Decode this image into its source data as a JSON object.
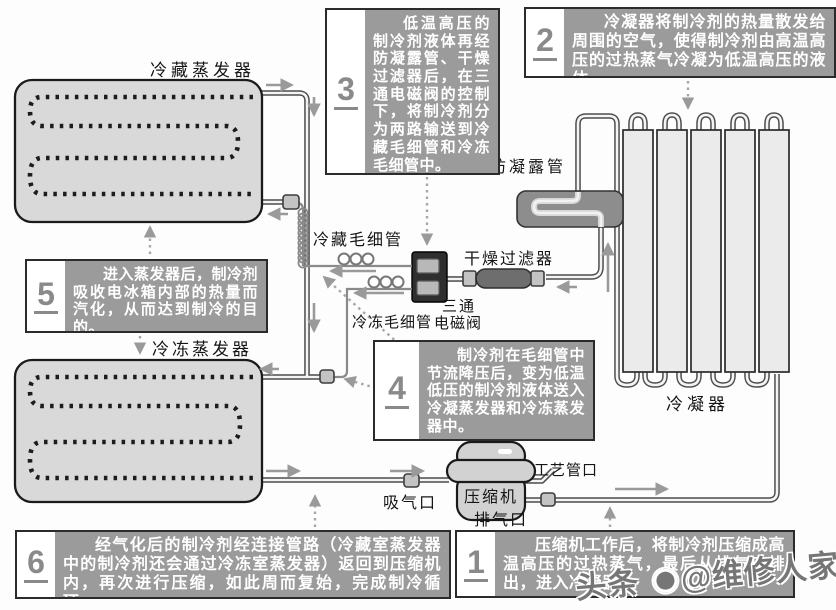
{
  "boxes": [
    {
      "num": "1",
      "text": "压缩机工作后，将制冷剂压缩成高温高压的过热蒸气，最后从排气口排出，进入冷凝器。"
    },
    {
      "num": "2",
      "text": "冷凝器将制冷剂的热量散发给周围的空气，使得制冷剂由高温高压的过热蒸气冷凝为低温高压的液体。"
    },
    {
      "num": "3",
      "text": "低温高压的制冷剂液体再经防凝露管、干燥过滤器后，在三通电磁阀的控制下，将制冷剂分为两路输送到冷藏毛细管和冷冻毛细管中。"
    },
    {
      "num": "4",
      "text": "制冷剂在毛细管中节流降压后，变为低温低压的制冷剂液体送入冷凝蒸发器和冷冻蒸发器中。"
    },
    {
      "num": "5",
      "text": "进入蒸发器后，制冷剂吸收电冰箱内部的热量而汽化，从而达到制冷的目的。"
    },
    {
      "num": "6",
      "text": "经气化后的制冷剂经连接管路（冷藏室蒸发器中的制冷剂还会通过冷冻室蒸发器）返回到压缩机内，再次进行压缩，如此周而复始，完成制冷循环。"
    }
  ],
  "labels": {
    "evap_fridge": "冷藏蒸发器",
    "evap_freezer": "冷冻蒸发器",
    "condenser": "冷凝器",
    "anti_condensation_tube": "防凝露管",
    "drying_filter": "干燥过滤器",
    "capillary_fridge": "冷藏毛细管",
    "capillary_freezer": "冷冻毛细管",
    "valve_line1": "三通",
    "valve_line2": "电磁阀",
    "compressor": "压缩机",
    "suction_port": "吸气口",
    "process_port": "工艺管口",
    "discharge_port": "排气口"
  },
  "watermark": {
    "prefix": "头条 ",
    "suffix": "@维修人家"
  },
  "colors": {
    "panel_bg": "#9b9b9b",
    "panel_text": "#ffffff",
    "number": "#8a8a8a",
    "arrow": "#9a9a9a",
    "evaporator_fill": "#d9d9d9",
    "condenser_fill": "#ebebeb",
    "valve_fill": "#2f2f2f"
  }
}
